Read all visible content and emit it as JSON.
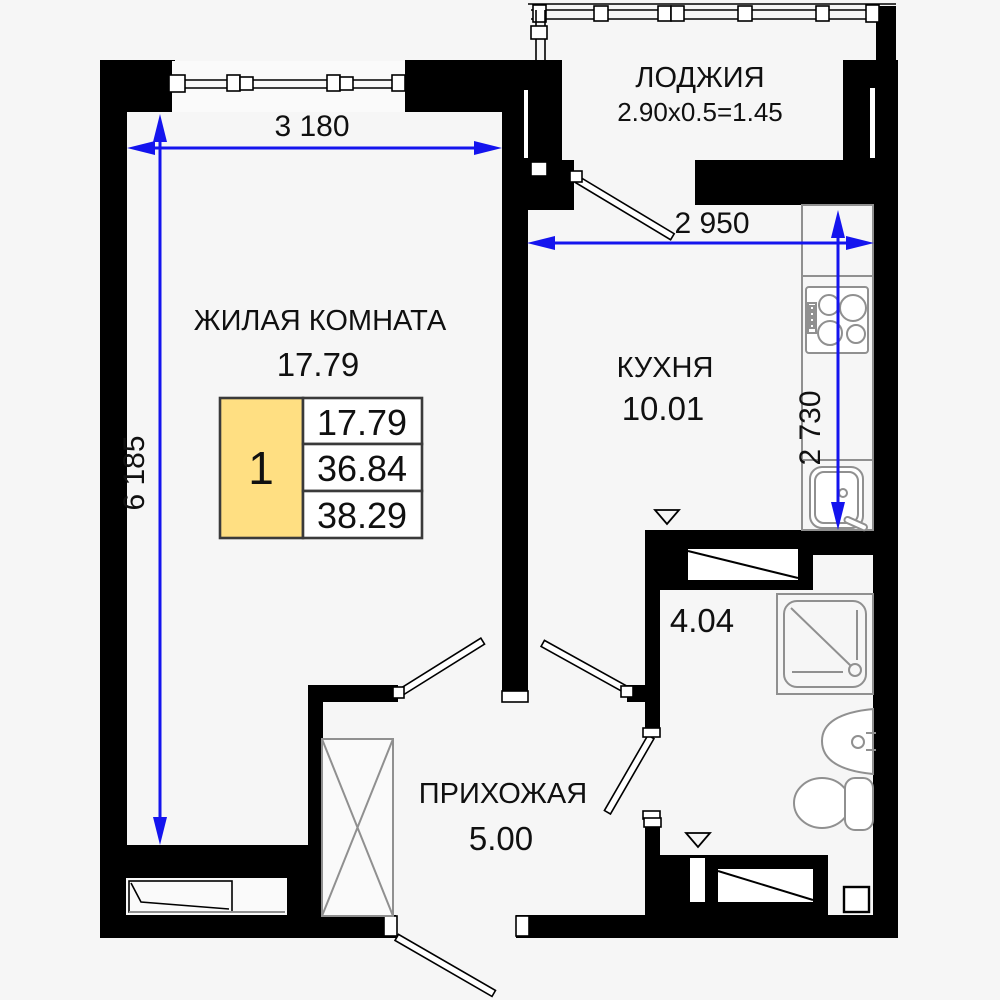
{
  "rooms": {
    "loggia": {
      "name": "ЛОДЖИЯ",
      "size_formula": "2.90x0.5=1.45"
    },
    "living_room": {
      "name": "ЖИЛАЯ КОМНАТА",
      "area": "17.79"
    },
    "kitchen": {
      "name": "КУХНЯ",
      "area": "10.01"
    },
    "bathroom": {
      "area": "4.04"
    },
    "hallway": {
      "name": "ПРИХОЖАЯ",
      "area": "5.00"
    }
  },
  "dimensions": {
    "living_room_width": "3 180",
    "living_room_length": "6 185",
    "kitchen_width": "2 950",
    "kitchen_length": "2 730"
  },
  "apartment_summary": {
    "rooms_count": "1",
    "living_area": "17.79",
    "area_without_balcony": "36.84",
    "total_area": "38.29"
  },
  "colors": {
    "dimension_line": "#1414ee",
    "walls": "#000000",
    "summary_highlight": "#ffdf82"
  }
}
